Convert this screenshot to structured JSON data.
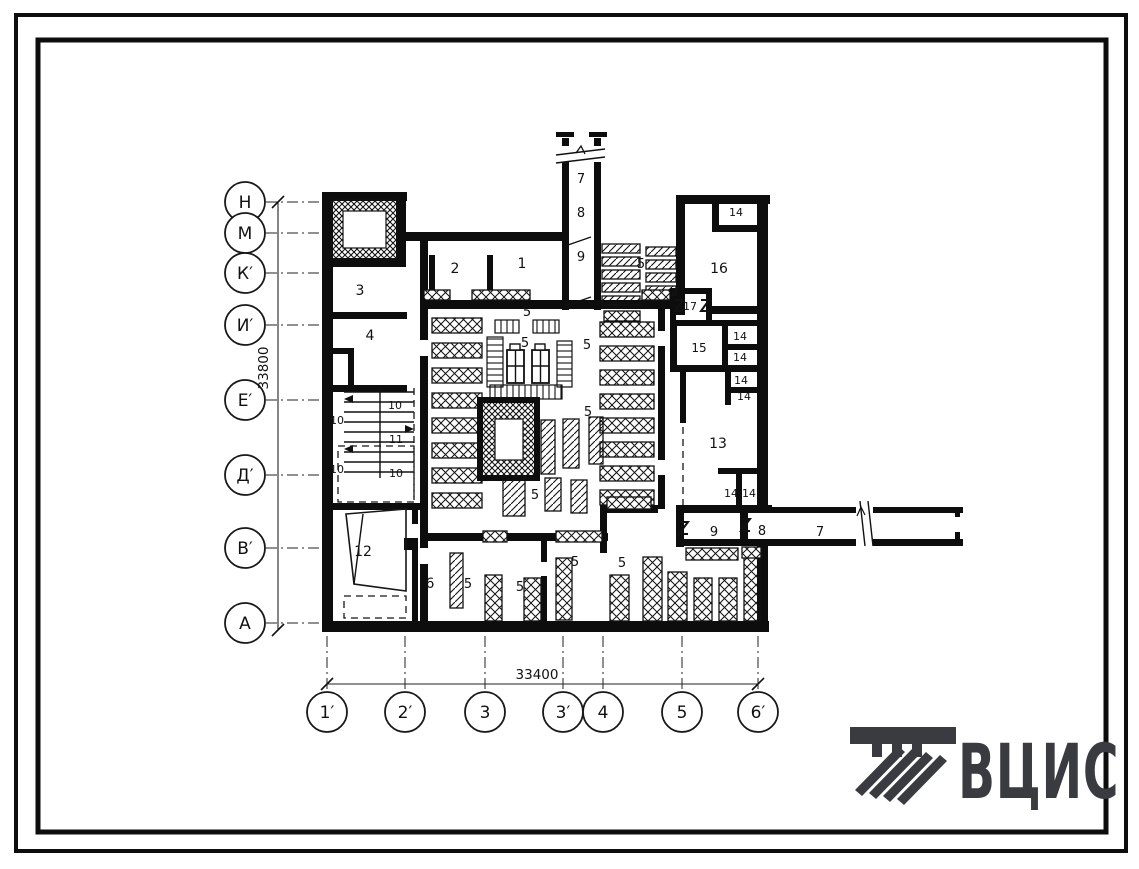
{
  "drawing": {
    "type": "architectural-floor-plan",
    "dimensions": {
      "horizontal": "33400",
      "vertical": "33800"
    },
    "axes": {
      "left": [
        {
          "label": "Н",
          "y": 202
        },
        {
          "label": "М",
          "y": 233
        },
        {
          "label": "К′",
          "y": 273
        },
        {
          "label": "И′",
          "y": 325
        },
        {
          "label": "Е′",
          "y": 400
        },
        {
          "label": "Д′",
          "y": 475
        },
        {
          "label": "В′",
          "y": 548
        },
        {
          "label": "А",
          "y": 623
        }
      ],
      "bottom": [
        {
          "label": "1′",
          "x": 327
        },
        {
          "label": "2′",
          "x": 405
        },
        {
          "label": "3",
          "x": 485
        },
        {
          "label": "3′",
          "x": 563
        },
        {
          "label": "4",
          "x": 603
        },
        {
          "label": "5",
          "x": 682
        },
        {
          "label": "6′",
          "x": 758
        }
      ]
    },
    "room_labels": [
      {
        "label": "1",
        "x": 522,
        "y": 268,
        "fs": 14
      },
      {
        "label": "2",
        "x": 455,
        "y": 273,
        "fs": 14
      },
      {
        "label": "3",
        "x": 360,
        "y": 295,
        "fs": 14
      },
      {
        "label": "4",
        "x": 370,
        "y": 340,
        "fs": 14
      },
      {
        "label": "5",
        "x": 527,
        "y": 316,
        "fs": 13
      },
      {
        "label": "5",
        "x": 525,
        "y": 347,
        "fs": 13
      },
      {
        "label": "5",
        "x": 587,
        "y": 349,
        "fs": 13
      },
      {
        "label": "5",
        "x": 588,
        "y": 416,
        "fs": 13
      },
      {
        "label": "5",
        "x": 535,
        "y": 499,
        "fs": 13
      },
      {
        "label": "5",
        "x": 641,
        "y": 268,
        "fs": 13
      },
      {
        "label": "6",
        "x": 430,
        "y": 588,
        "fs": 14
      },
      {
        "label": "5",
        "x": 468,
        "y": 588,
        "fs": 13
      },
      {
        "label": "5",
        "x": 520,
        "y": 591,
        "fs": 13
      },
      {
        "label": "5",
        "x": 575,
        "y": 566,
        "fs": 13
      },
      {
        "label": "5",
        "x": 622,
        "y": 567,
        "fs": 13
      },
      {
        "label": "7",
        "x": 581,
        "y": 183,
        "fs": 13
      },
      {
        "label": "8",
        "x": 581,
        "y": 217,
        "fs": 13
      },
      {
        "label": "9",
        "x": 581,
        "y": 261,
        "fs": 13
      },
      {
        "label": "9",
        "x": 714,
        "y": 536,
        "fs": 13
      },
      {
        "label": "8",
        "x": 762,
        "y": 535,
        "fs": 13
      },
      {
        "label": "7",
        "x": 820,
        "y": 536,
        "fs": 13
      },
      {
        "label": "10",
        "x": 337,
        "y": 424,
        "fs": 11
      },
      {
        "label": "10",
        "x": 395,
        "y": 409,
        "fs": 11
      },
      {
        "label": "11",
        "x": 396,
        "y": 443,
        "fs": 11
      },
      {
        "label": "10",
        "x": 337,
        "y": 473,
        "fs": 11
      },
      {
        "label": "10",
        "x": 396,
        "y": 477,
        "fs": 11
      },
      {
        "label": "12",
        "x": 363,
        "y": 556,
        "fs": 14
      },
      {
        "label": "13",
        "x": 718,
        "y": 448,
        "fs": 14
      },
      {
        "label": "14",
        "x": 736,
        "y": 216,
        "fs": 11
      },
      {
        "label": "14",
        "x": 740,
        "y": 340,
        "fs": 11
      },
      {
        "label": "14",
        "x": 740,
        "y": 361,
        "fs": 11
      },
      {
        "label": "14",
        "x": 741,
        "y": 384,
        "fs": 11
      },
      {
        "label": "14",
        "x": 744,
        "y": 400,
        "fs": 11
      },
      {
        "label": "14",
        "x": 731,
        "y": 497,
        "fs": 11
      },
      {
        "label": "14",
        "x": 749,
        "y": 497,
        "fs": 11
      },
      {
        "label": "15",
        "x": 699,
        "y": 352,
        "fs": 12
      },
      {
        "label": "16",
        "x": 719,
        "y": 273,
        "fs": 14
      },
      {
        "label": "17",
        "x": 690,
        "y": 310,
        "fs": 11
      }
    ],
    "logo": {
      "text": "ВЦИС",
      "color": "#3a3a41"
    }
  }
}
